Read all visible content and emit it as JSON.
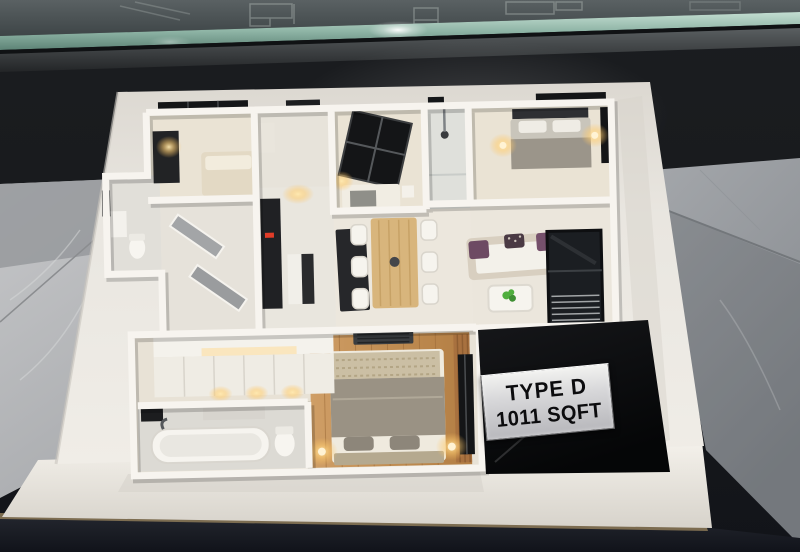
{
  "sign": {
    "type_label": "TYPE D",
    "area_label": "1011 SQFT"
  },
  "palette": {
    "cabinet_black": "#17191c",
    "glass_tint_edge": "#9ec4b6",
    "marble_light_grey": "#bcbdbf",
    "marble_dark_grey": "#94979b",
    "platform_white": "#eae7e1",
    "wall_white": "#f7f4ef",
    "floor_cream": "#eae3d4",
    "wood_light": "#c89a62",
    "wood_dark": "#a8713f",
    "counter_black": "#202124",
    "window_black": "#141517",
    "warm_light": "#ffd98f",
    "sofa_purple": "#6d4a63",
    "plant_green": "#4fae3d",
    "table_surface_navy": "#171a20",
    "sign_plinth_black": "#0a0b0d",
    "sign_plate_silver": "#d8d8da"
  }
}
